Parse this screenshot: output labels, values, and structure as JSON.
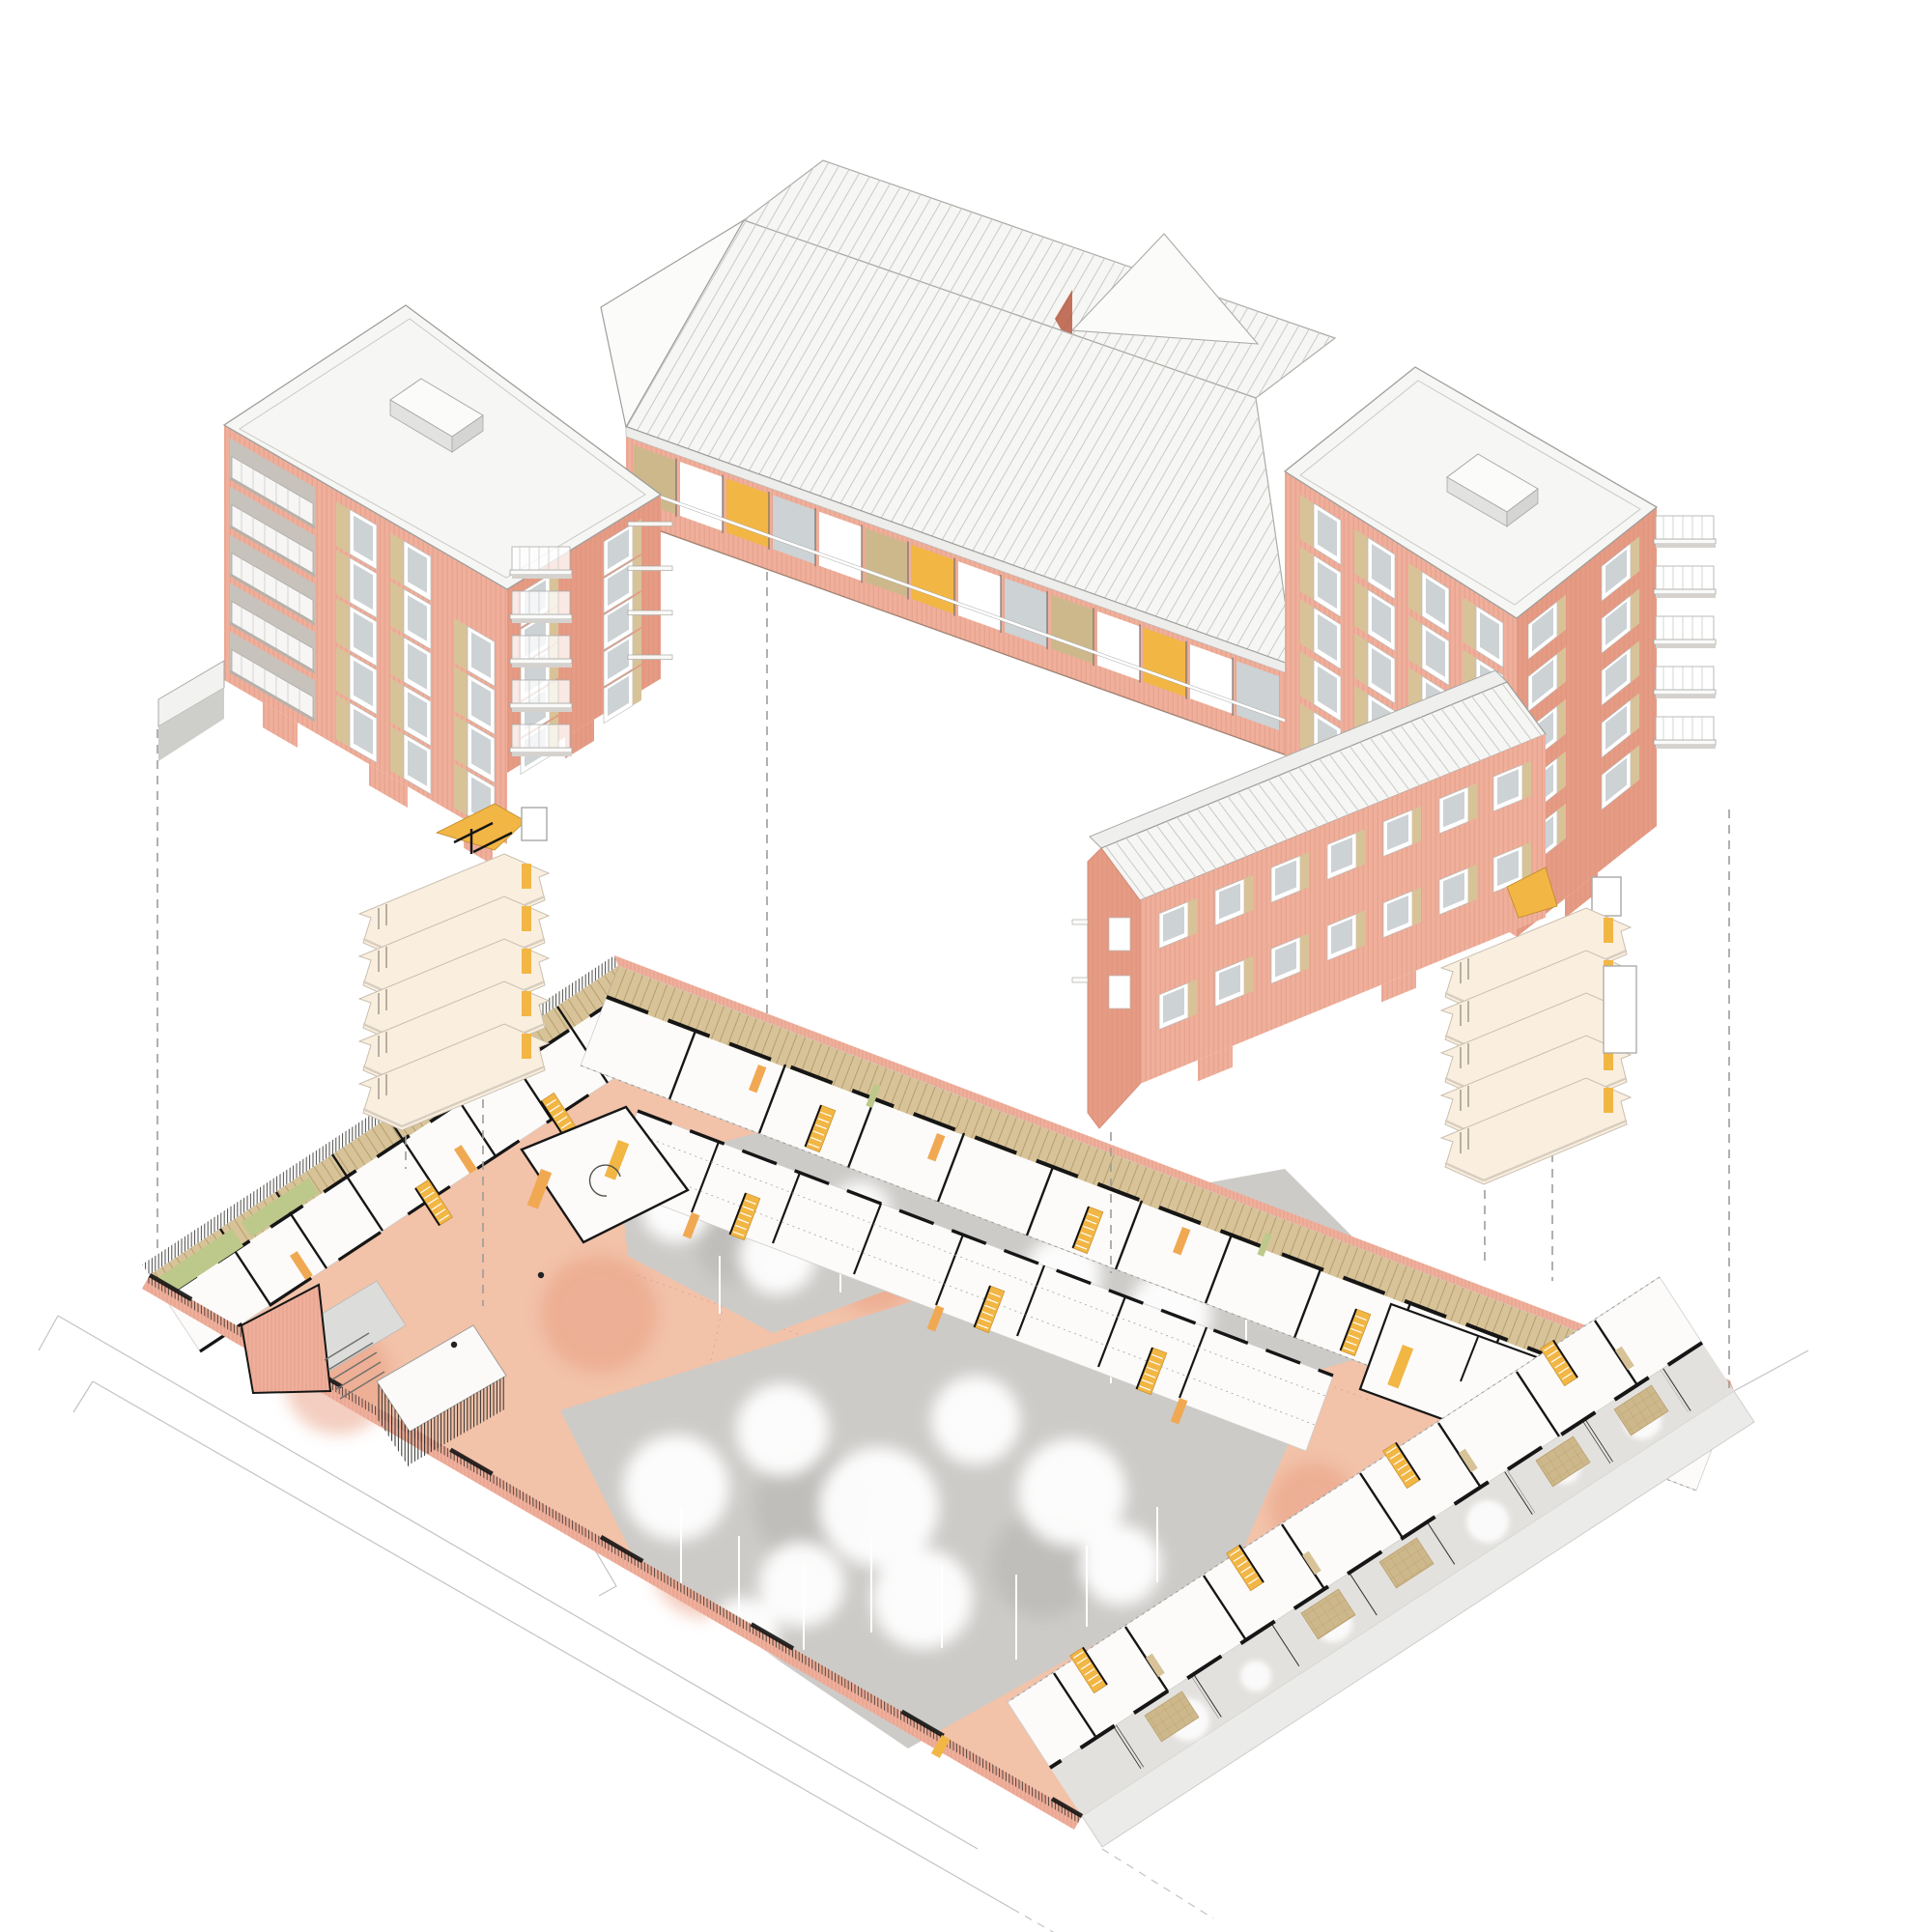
{
  "document_title": "Exploded axonometric - courtyard housing block",
  "drawing": {
    "type": "exploded-axonometric-architecture-diagram",
    "subject": "U-shaped brick apartment block lifted above its ground-floor plan and courtyard garden",
    "components": {
      "upper_building": [
        "west-tower",
        "gallery-wing",
        "east-tower",
        "lower-wing"
      ],
      "stair_cores": [
        "west-stair-core",
        "east-stair-core"
      ],
      "ground_plan": [
        "northwest-room-band",
        "northeast-room-band",
        "inner-room-band",
        "east-room-cluster",
        "townhouse-garden-band",
        "entrance-plaza",
        "courtyard-trees",
        "perimeter-fence",
        "street-outline"
      ],
      "annotations": [
        "vertical-projection-dashed-lines"
      ]
    }
  },
  "palette": {
    "paper": "#FFFFFF",
    "brick": "#EFAF9B",
    "brickShade": "#E69B85",
    "brickLine": "#D98D76",
    "brickDark": "#B95B41",
    "roof": "#F6F6F4",
    "roofLine": "#C9C9C6",
    "glass": "#CDD2D5",
    "tan": "#D8C398",
    "wood": "#CDB88C",
    "yellow": "#F2B644",
    "orange": "#F0A952",
    "plate": "#FAEFDF",
    "salmon": "#F2C2A9",
    "salmonDeep": "#E89C80",
    "planPale": "#F8E2D2",
    "forest": "#CDCBC8",
    "green": "#BDC98A",
    "sidewalk": "#EBEBE9",
    "line": "#C3C3C0",
    "dash": "#9C9C9A",
    "ink": "#161616"
  }
}
